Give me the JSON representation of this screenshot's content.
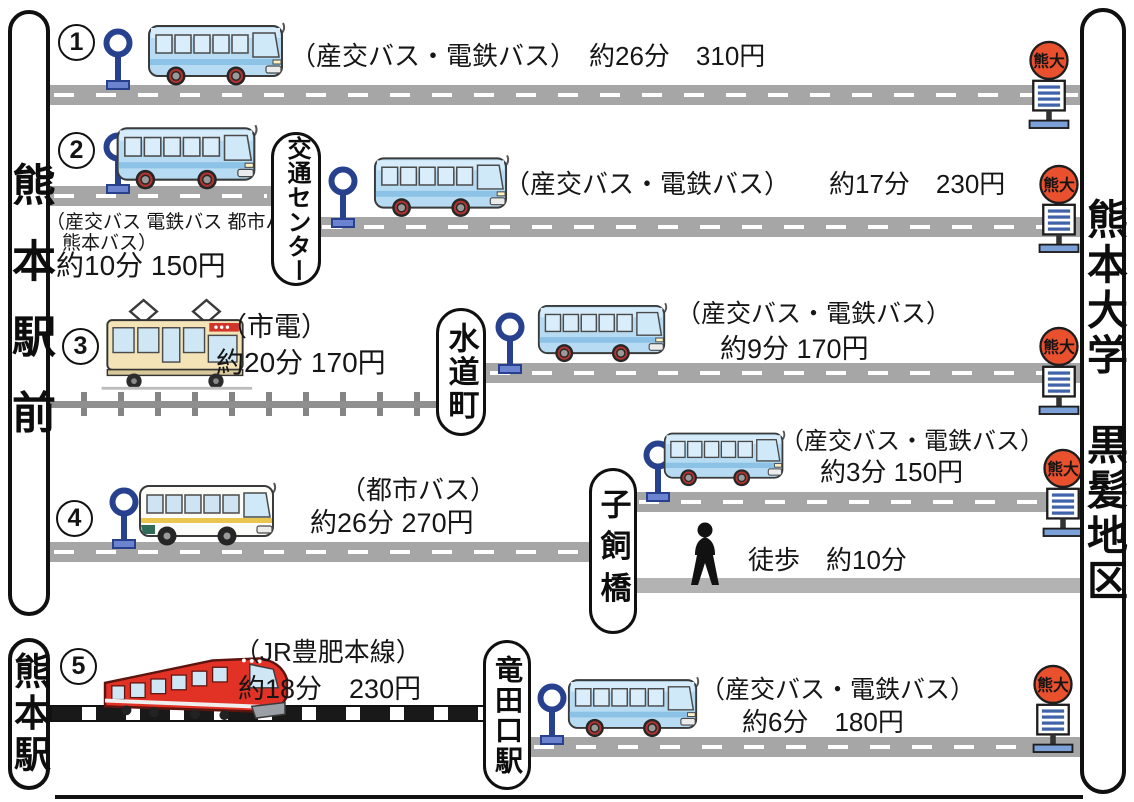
{
  "title": "熊本駅から熊本大学黒髪地区へのアクセス",
  "stations": {
    "left_top": "熊本駅前",
    "left_bottom": "熊本駅",
    "right": "熊本大学　黒髪地区",
    "kotsu_center": "交通センター",
    "suidocho": "水道町",
    "kokaibashi": "子飼橋",
    "tatsutaguchi": "竜田口駅"
  },
  "sign": {
    "kumadai": "熊大"
  },
  "routes": {
    "r1": {
      "num": "1",
      "label": "（産交バス・電鉄バス）　約26分　310円"
    },
    "r2": {
      "num": "2",
      "leg1_line1": "（産交バス 電鉄バス 都市バス",
      "leg1_line2": "熊本バス）",
      "leg1_fare": "約10分 150円",
      "leg2": "（産交バス・電鉄バス）　　約17分　230円"
    },
    "r3": {
      "num": "3",
      "leg1_name": "（市電）",
      "leg1_fare": "約20分 170円",
      "leg2_name": "（産交バス・電鉄バス）",
      "leg2_fare": "約9分 170円"
    },
    "r4": {
      "num": "4",
      "leg1_name": "（都市バス）",
      "leg1_fare": "約26分 270円",
      "leg2_name": "（産交バス・電鉄バス）",
      "leg2_fare": "約3分 150円",
      "walk": "徒歩　約10分"
    },
    "r5": {
      "num": "5",
      "leg1_name": "（JR豊肥本線）",
      "leg1_fare": "約18分　230円",
      "leg2_name": "（産交バス・電鉄バス）",
      "leg2_fare": "約6分　180円"
    }
  },
  "colors": {
    "road": "#a6a6a6",
    "bus_body": "#b6dbf2",
    "city_bus_body": "#fbfbf7",
    "tram_body": "#f3e3b6",
    "jr_train": "#e23226",
    "stop_sign": "#e8502e",
    "pole_blue": "#27418f"
  }
}
